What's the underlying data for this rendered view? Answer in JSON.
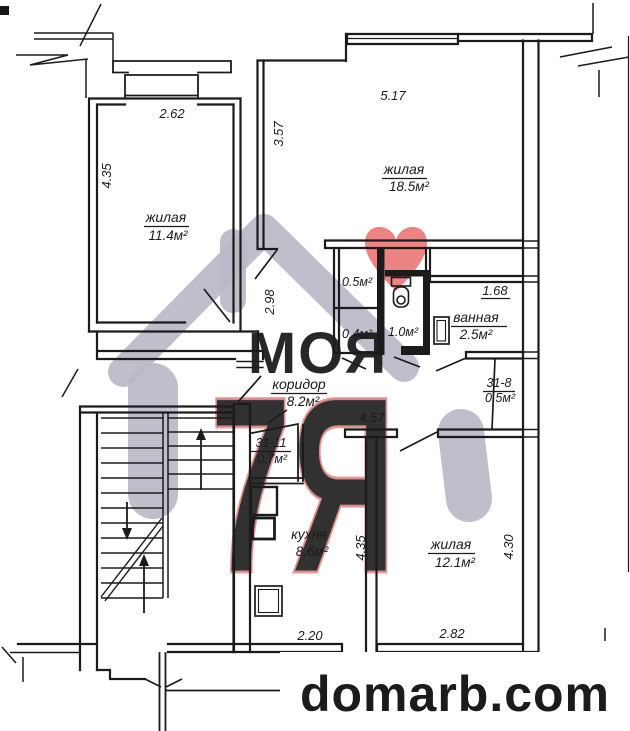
{
  "site": {
    "domain": "domarb.com",
    "color": "#8d1216"
  },
  "watermark": {
    "line_top": "МОЯ",
    "line_bottom": "7Я",
    "house_color": "#b8b8c6",
    "text_top_color": "#a6a6b8",
    "pink_color": "#f1a7a7",
    "pink_outline": "#e89090",
    "heart_color": "#ee8383"
  },
  "rooms": {
    "living1": {
      "name": "жилая",
      "area": "11.4м²"
    },
    "living2": {
      "name": "жилая",
      "area": "18.5м²"
    },
    "living3": {
      "name": "жилая",
      "area": "12.1м²"
    },
    "kitchen": {
      "name": "кухня",
      "area": "8.6м²"
    },
    "bathroom": {
      "name": "ванная",
      "area": "2.5м²"
    },
    "corridor": {
      "name": "коридор",
      "area": "8.2м²"
    },
    "wc": {
      "area": "1.0м²"
    },
    "storage_top": {
      "area": "0.5м²"
    },
    "storage_mid": {
      "area": "0.4м²"
    },
    "storage_31_8": {
      "name": "31-8",
      "area": "0.5м²"
    },
    "storage_31_11": {
      "name": "31-11",
      "area": "0.7м²"
    }
  },
  "dimensions": {
    "living1_width": "2.62",
    "living1_height": "4.35",
    "living2_left_height": "3.57",
    "living2_width": "5.17",
    "partition_height": "2.98",
    "bathroom_width": "1.68",
    "corridor_width": "4.57",
    "kitchen_height": "4.35",
    "kitchen_width": "2.20",
    "living3_width": "2.82",
    "living3_height": "4.30"
  }
}
